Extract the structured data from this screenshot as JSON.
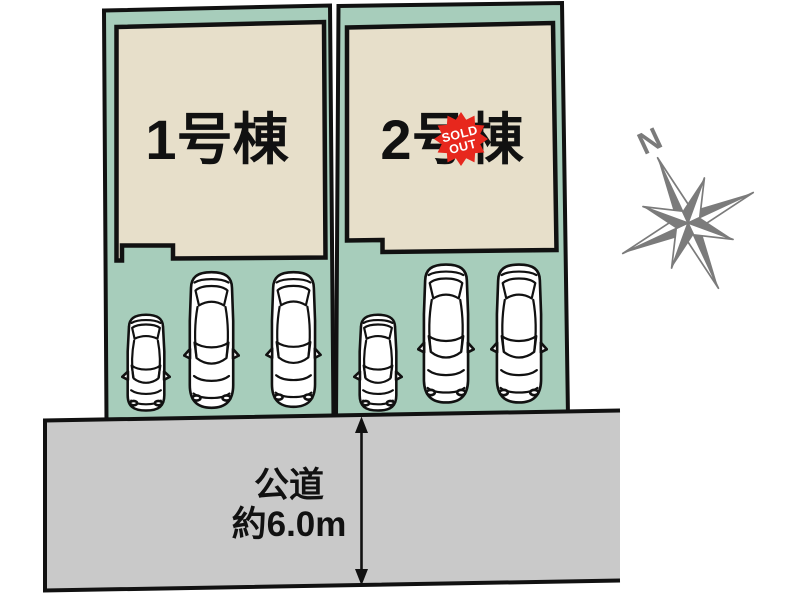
{
  "site_plan": {
    "lot1": {
      "label": "1号棟"
    },
    "lot2": {
      "label": "2号棟",
      "status_badge": {
        "line1": "SOLD",
        "line2": "OUT"
      }
    },
    "road": {
      "name": "公道",
      "width": "約6.0m"
    },
    "compass": {
      "north_label": "N"
    },
    "cars": {
      "lot1_count": 3,
      "lot2_count": 3
    },
    "colors": {
      "lot_green": "#a7cdbb",
      "building_beige": "#e7dfca",
      "road_gray": "#c9c9c9",
      "outline_black": "#111111",
      "sold_out_red": "#e7271d",
      "compass_gray": "#7b7b7b"
    }
  }
}
